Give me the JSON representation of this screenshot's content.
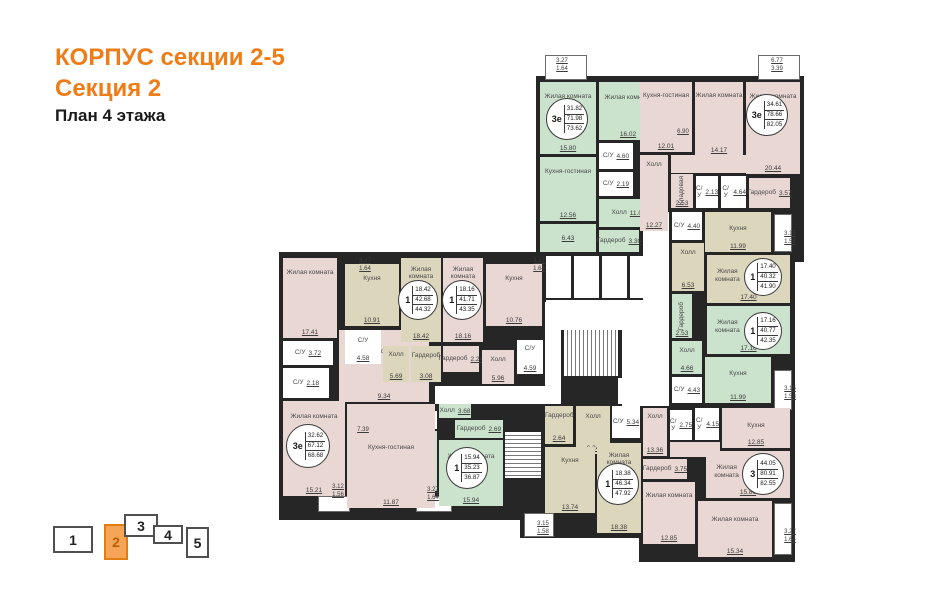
{
  "title": {
    "building": "КОРПУС секции 2-5",
    "section": "Секция 2",
    "floor": "План 4 этажа"
  },
  "colors": {
    "accent": "#ee7d18",
    "pink": "#e9d7d3",
    "green": "#cbe3cd",
    "beige": "#dcd6bd",
    "white_room": "#ffffff",
    "wall": "#262626",
    "nav_active_fill": "#f6a455"
  },
  "section_nav": {
    "items": [
      {
        "label": "1",
        "active": false
      },
      {
        "label": "2",
        "active": true
      },
      {
        "label": "3",
        "active": false
      },
      {
        "label": "4",
        "active": false
      },
      {
        "label": "5",
        "active": false
      }
    ]
  },
  "apartments": [
    {
      "id": "apt-top-left-green",
      "type": "3е",
      "stats": [
        "31.82",
        "71.98",
        "73.62"
      ],
      "color": "green",
      "circle": {
        "x": 546,
        "y": 98,
        "d": 42
      },
      "rooms": [
        {
          "name": "Жилая комната",
          "area": "15.80",
          "rect": [
            540,
            82,
            56,
            72
          ]
        },
        {
          "name": "Жилая комната",
          "area": "16.02",
          "rect": [
            599,
            82,
            58,
            58
          ]
        },
        {
          "name": "С/У",
          "area": "4.60",
          "rect": [
            599,
            143,
            34,
            26
          ],
          "white": true
        },
        {
          "name": "С/У",
          "area": "2.19",
          "rect": [
            599,
            172,
            34,
            24
          ],
          "white": true
        },
        {
          "name": "Кухня-гостиная",
          "area": "12.56",
          "rect": [
            540,
            157,
            56,
            64
          ]
        },
        {
          "name": "",
          "area": "6.43",
          "rect": [
            540,
            224,
            56,
            28
          ]
        },
        {
          "name": "Холл",
          "area": "11.08",
          "rect": [
            599,
            199,
            59,
            28
          ]
        },
        {
          "name": "Гардероб",
          "area": "3.30",
          "rect": [
            599,
            230,
            40,
            22
          ]
        }
      ]
    },
    {
      "id": "apt-top-right-pink",
      "type": "3е",
      "stats": [
        "34.61",
        "78.66",
        "82.05"
      ],
      "color": "pink",
      "circle": {
        "x": 746,
        "y": 94,
        "d": 42
      },
      "rooms": [
        {
          "name": "Кухня-гостиная",
          "area": "12.01",
          "rect": [
            640,
            82,
            52,
            70
          ]
        },
        {
          "name": "Жилая комната",
          "area": "14.17",
          "rect": [
            695,
            82,
            48,
            74
          ]
        },
        {
          "name": "Жилая комната",
          "area": "20.44",
          "rect": [
            746,
            82,
            54,
            92
          ]
        },
        {
          "name": "Холл",
          "area": "12.27",
          "rect": [
            640,
            155,
            28,
            76
          ]
        },
        {
          "name": "",
          "area": "",
          "rect": [
            671,
            155,
            75,
            18
          ]
        },
        {
          "name": "Кладовая",
          "area": "2.53",
          "rect": [
            671,
            174,
            22,
            34
          ],
          "vert": true
        },
        {
          "name": "С/У",
          "area": "2.13",
          "rect": [
            696,
            176,
            22,
            32
          ],
          "white": true
        },
        {
          "name": "С/У",
          "area": "4.64",
          "rect": [
            721,
            176,
            25,
            32
          ],
          "white": true
        },
        {
          "name": "Гардероб",
          "area": "3.57",
          "rect": [
            749,
            178,
            41,
            30
          ]
        }
      ]
    },
    {
      "id": "apt-right-beige-1",
      "type": "1",
      "stats": [
        "17.40",
        "40.32",
        "41.90"
      ],
      "color": "beige",
      "circle": {
        "x": 744,
        "y": 258,
        "d": 38
      },
      "rooms": [
        {
          "name": "С/У",
          "area": "4.40",
          "rect": [
            672,
            212,
            30,
            28
          ],
          "white": true
        },
        {
          "name": "Кухня",
          "area": "11.99",
          "rect": [
            705,
            212,
            66,
            40
          ]
        },
        {
          "name": "Холл",
          "area": "6.53",
          "rect": [
            672,
            243,
            32,
            48
          ]
        },
        {
          "name": "Жилая комната",
          "area": "17.40",
          "rect": [
            707,
            255,
            83,
            48
          ],
          "np": "left"
        }
      ]
    },
    {
      "id": "apt-right-green-1",
      "type": "1",
      "stats": [
        "17.16",
        "40.77",
        "42.35"
      ],
      "color": "green",
      "circle": {
        "x": 744,
        "y": 312,
        "d": 38
      },
      "rooms": [
        {
          "name": "Гардероб",
          "area": "2.53",
          "rect": [
            672,
            294,
            20,
            44
          ],
          "vert": true
        },
        {
          "name": "Жилая комната",
          "area": "17.16",
          "rect": [
            707,
            306,
            83,
            48
          ],
          "np": "left"
        },
        {
          "name": "Холл",
          "area": "4.66",
          "rect": [
            672,
            341,
            30,
            33
          ]
        },
        {
          "name": "С/У",
          "area": "4.43",
          "rect": [
            672,
            377,
            30,
            26
          ],
          "white": true
        },
        {
          "name": "Кухня",
          "area": "11.99",
          "rect": [
            705,
            357,
            66,
            46
          ]
        }
      ]
    },
    {
      "id": "apt-bottom-right-pink-3",
      "type": "3",
      "stats": [
        "44.05",
        "80.91",
        "82.55"
      ],
      "color": "pink",
      "circle": {
        "x": 742,
        "y": 453,
        "d": 42
      },
      "rooms": [
        {
          "name": "Холл",
          "area": "13.36",
          "rect": [
            643,
            408,
            24,
            48
          ]
        },
        {
          "name": "С/У",
          "area": "2.75",
          "rect": [
            670,
            410,
            22,
            30
          ],
          "white": true
        },
        {
          "name": "С/У",
          "area": "4.15",
          "rect": [
            695,
            408,
            24,
            32
          ],
          "white": true
        },
        {
          "name": "Кухня",
          "area": "12.85",
          "rect": [
            722,
            408,
            68,
            40
          ]
        },
        {
          "name": "",
          "area": "",
          "rect": [
            670,
            442,
            50,
            15
          ]
        },
        {
          "name": "Гардероб",
          "area": "3.75",
          "rect": [
            643,
            459,
            44,
            20
          ]
        },
        {
          "name": "Жилая комната",
          "area": "15.86",
          "rect": [
            706,
            451,
            84,
            47
          ],
          "np": "left"
        },
        {
          "name": "Жилая комната",
          "area": "12.85",
          "rect": [
            643,
            482,
            52,
            62
          ]
        },
        {
          "name": "Жилая комната",
          "area": "15.34",
          "rect": [
            698,
            501,
            74,
            56
          ]
        }
      ]
    },
    {
      "id": "apt-bottom-beige-1",
      "type": "1",
      "stats": [
        "18.38",
        "46.34",
        "47.92"
      ],
      "color": "beige",
      "circle": {
        "x": 597,
        "y": 463,
        "d": 42
      },
      "rooms": [
        {
          "name": "Гардероб",
          "area": "2.64",
          "rect": [
            545,
            406,
            28,
            38
          ]
        },
        {
          "name": "Холл",
          "area": "6.24",
          "rect": [
            576,
            406,
            34,
            48
          ]
        },
        {
          "name": "С/У",
          "area": "5.34",
          "rect": [
            612,
            406,
            28,
            32
          ],
          "white": true
        },
        {
          "name": "Кухня",
          "area": "13.74",
          "rect": [
            545,
            447,
            50,
            66
          ]
        },
        {
          "name": "Жилая комната",
          "area": "18.38",
          "rect": [
            597,
            443,
            44,
            90
          ]
        }
      ]
    },
    {
      "id": "apt-bottom-green-1",
      "type": "1",
      "stats": [
        "15.94",
        "35.23",
        "36.87"
      ],
      "color": "green",
      "circle": {
        "x": 446,
        "y": 447,
        "d": 42
      },
      "rooms": [
        {
          "name": "С/У",
          "area": "4.19",
          "rect": [
            395,
            411,
            42,
            18
          ],
          "white": true
        },
        {
          "name": "Кухня",
          "area": "8.73",
          "rect": [
            395,
            431,
            42,
            60
          ]
        },
        {
          "name": "Холл",
          "area": "3.68",
          "rect": [
            439,
            404,
            32,
            14
          ]
        },
        {
          "name": "Гардероб",
          "area": "2.69",
          "rect": [
            455,
            420,
            48,
            18
          ]
        },
        {
          "name": "Жилая комната",
          "area": "15.94",
          "rect": [
            439,
            440,
            64,
            66
          ]
        }
      ]
    },
    {
      "id": "apt-left-pink-3e",
      "type": "3е",
      "stats": [
        "32.62",
        "67.12",
        "68.68"
      ],
      "color": "pink",
      "circle": {
        "x": 286,
        "y": 424,
        "d": 44
      },
      "rooms": [
        {
          "name": "Жилая комната",
          "area": "17.41",
          "rect": [
            283,
            258,
            54,
            80
          ]
        },
        {
          "name": "С/У",
          "area": "3.72",
          "rect": [
            283,
            341,
            50,
            24
          ],
          "white": true
        },
        {
          "name": "С/У",
          "area": "2.18",
          "rect": [
            283,
            368,
            46,
            30
          ],
          "white": true
        },
        {
          "name": "Холл",
          "area": "9.34",
          "rect": [
            339,
            330,
            90,
            72
          ]
        },
        {
          "name": "Жилая комната",
          "area": "15.21",
          "rect": [
            283,
            401,
            62,
            95
          ]
        },
        {
          "name": "Кухня-гостиная",
          "area": "11.87",
          "rect": [
            347,
            404,
            88,
            104
          ],
          "ny": 45
        }
      ]
    },
    {
      "id": "apt-left-beige-1",
      "type": "1",
      "stats": [
        "18.42",
        "42.68",
        "44.32"
      ],
      "color": "beige",
      "circle": {
        "x": 398,
        "y": 280,
        "d": 40
      },
      "rooms": [
        {
          "name": "Кухня",
          "area": "10.91",
          "rect": [
            345,
            264,
            54,
            62
          ]
        },
        {
          "name": "Жилая комната",
          "area": "18.42",
          "rect": [
            401,
            258,
            40,
            84
          ]
        },
        {
          "name": "С/У",
          "area": "4.58",
          "rect": [
            345,
            330,
            36,
            34
          ],
          "white": true
        },
        {
          "name": "Холл",
          "area": "5.69",
          "rect": [
            383,
            346,
            26,
            36
          ]
        },
        {
          "name": "Гардероб",
          "area": "3.08",
          "rect": [
            411,
            346,
            30,
            36
          ]
        }
      ]
    },
    {
      "id": "apt-left-pink-1",
      "type": "1",
      "stats": [
        "18.16",
        "41.71",
        "43.35"
      ],
      "color": "pink",
      "circle": {
        "x": 442,
        "y": 280,
        "d": 40
      },
      "rooms": [
        {
          "name": "Жилая комната",
          "area": "18.16",
          "rect": [
            443,
            258,
            40,
            84
          ]
        },
        {
          "name": "Кухня",
          "area": "10.76",
          "rect": [
            486,
            264,
            56,
            62
          ]
        },
        {
          "name": "Гардероб",
          "area": "2.24",
          "rect": [
            443,
            346,
            36,
            26
          ]
        },
        {
          "name": "Холл",
          "area": "5.96",
          "rect": [
            482,
            350,
            32,
            34
          ]
        },
        {
          "name": "С/У",
          "area": "4.59",
          "rect": [
            517,
            340,
            26,
            34
          ],
          "white": true
        }
      ]
    }
  ],
  "dims": [
    {
      "lines": [
        "3.27",
        "1.64"
      ],
      "x": 549,
      "y": 57
    },
    {
      "lines": [
        "6.77",
        "3.39"
      ],
      "x": 764,
      "y": 57
    },
    {
      "lines": [
        "3.27",
        "1.64"
      ],
      "x": 352,
      "y": 257
    },
    {
      "lines": [
        "3.27",
        "1.64"
      ],
      "x": 526,
      "y": 257
    },
    {
      "lines": [
        "3.15",
        "1.58"
      ],
      "x": 777,
      "y": 230
    },
    {
      "lines": [
        "3.15",
        "1.58"
      ],
      "x": 777,
      "y": 385
    },
    {
      "lines": [
        "3.27",
        "1.64"
      ],
      "x": 777,
      "y": 528
    },
    {
      "lines": [
        "3.12",
        "1.56"
      ],
      "x": 325,
      "y": 483
    },
    {
      "lines": [
        "3.27",
        "1.64"
      ],
      "x": 420,
      "y": 486
    },
    {
      "lines": [
        "3.15",
        "1.58"
      ],
      "x": 530,
      "y": 520
    },
    {
      "lines": [
        "6.90"
      ],
      "x": 670,
      "y": 128
    },
    {
      "lines": [
        "7.39"
      ],
      "x": 350,
      "y": 426
    }
  ]
}
